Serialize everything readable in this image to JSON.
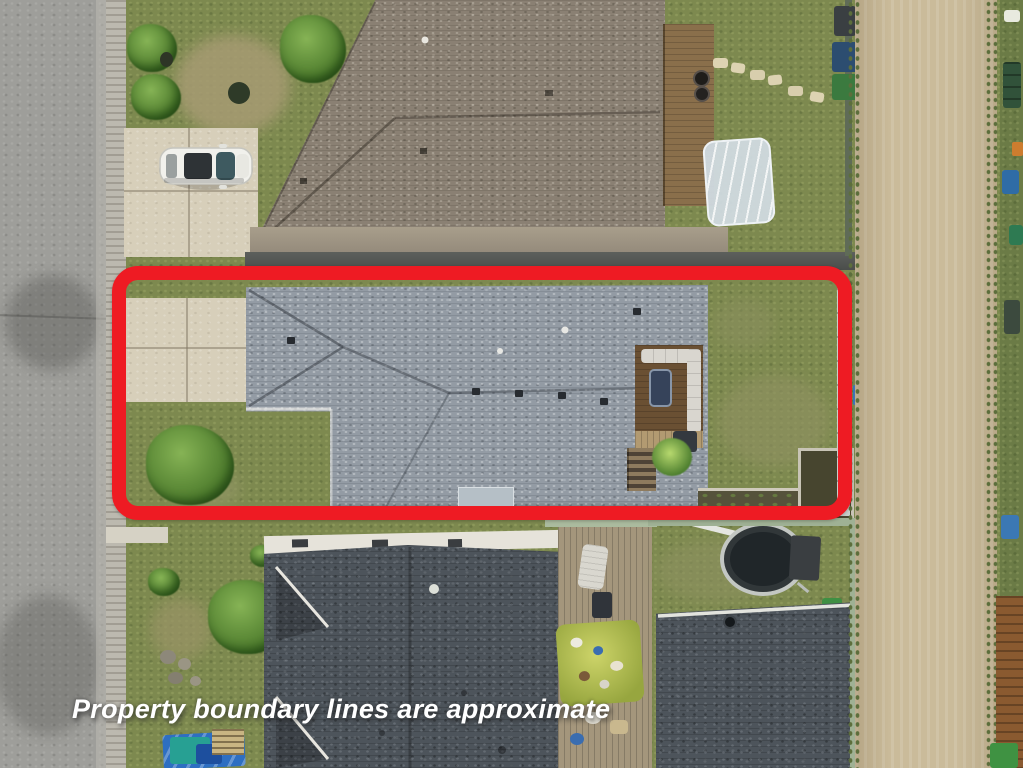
{
  "photo": {
    "caption": "Property boundary lines are approximate"
  },
  "boundary": {
    "color": "#ee1b23"
  },
  "palette": {
    "road": "#9e9e9a",
    "sidewalk": "#bcb9af",
    "concrete_driveway": "#d7cfba",
    "grass_base": "#7d894f",
    "roof_subject_gray": "#939ba4",
    "roof_top_neighbor": "#8a8073",
    "roof_bottom_neighbor": "#4d545b",
    "alley_gravel": "#cabb9a",
    "deck_wood_dark": "#6a5033",
    "hot_tub_navy": "#36435a",
    "trampoline_black": "#202629",
    "tarp_blue": "#2e6fc2",
    "caption_white": "#ffffff"
  }
}
